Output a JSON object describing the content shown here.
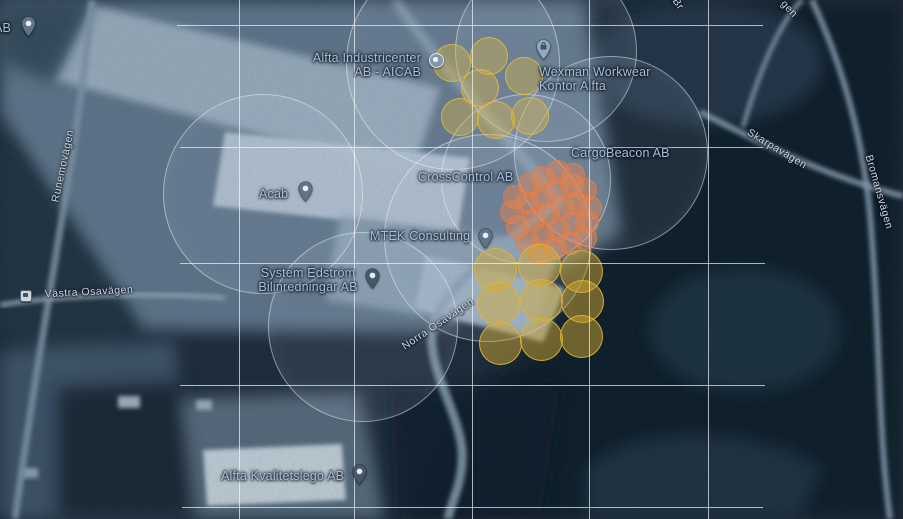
{
  "map": {
    "description_labels": {
      "places": [
        {
          "id": "partial-ab",
          "lines": [
            "AB"
          ],
          "x": -6,
          "y": 22,
          "align": "left"
        },
        {
          "id": "alfta-industricenter",
          "lines": [
            "Alfta Industricenter",
            "AB - AICAB"
          ],
          "x": 421,
          "y": 52,
          "align": "right"
        },
        {
          "id": "wexman-workwear",
          "lines": [
            "Wexman Workwear",
            "Kontor Alfta"
          ],
          "x": 539,
          "y": 66,
          "align": "left"
        },
        {
          "id": "cargobeacon",
          "lines": [
            "CargoBeacon AB"
          ],
          "x": 571,
          "y": 147,
          "align": "left"
        },
        {
          "id": "crosscontrol",
          "lines": [
            "CrossControl AB"
          ],
          "x": 418,
          "y": 171,
          "align": "left"
        },
        {
          "id": "acab",
          "lines": [
            "Acab"
          ],
          "x": 259,
          "y": 188,
          "align": "left"
        },
        {
          "id": "mtek-consulting",
          "lines": [
            "MTEK Consulting"
          ],
          "x": 370,
          "y": 230,
          "align": "left"
        },
        {
          "id": "system-edstrom",
          "lines": [
            "System Edström",
            "Bilinredningar AB"
          ],
          "x": 308,
          "y": 267,
          "align": "center"
        },
        {
          "id": "alfta-kvalitetslego",
          "lines": [
            "Alfta Kvalitetslego AB"
          ],
          "x": 221,
          "y": 470,
          "align": "left"
        }
      ],
      "roads": [
        {
          "id": "runemovagen",
          "text": "Runemovägen",
          "x": 63,
          "y": 166,
          "rotate": -78
        },
        {
          "id": "vastra-osavagen",
          "text": "Västra Osavägen",
          "x": 89,
          "y": 292,
          "rotate": -3
        },
        {
          "id": "norra-osavagen",
          "text": "Norra Osavägen",
          "x": 438,
          "y": 324,
          "rotate": -34
        },
        {
          "id": "skarpavagen",
          "text": "Skarpavägen",
          "x": 777,
          "y": 149,
          "rotate": 31
        },
        {
          "id": "bromansvagen",
          "text": "Bromansvägen",
          "x": 879,
          "y": 192,
          "rotate": 74
        },
        {
          "id": "partial-br",
          "text": "Br",
          "x": 678,
          "y": 4,
          "rotate": 56
        },
        {
          "id": "partial-gen",
          "text": "gen",
          "x": 789,
          "y": 9,
          "rotate": 47
        }
      ]
    },
    "grid": {
      "h_lines": [
        {
          "y": 25,
          "x1": 177,
          "x2": 763
        },
        {
          "y": 147,
          "x1": 180,
          "x2": 763
        },
        {
          "y": 263,
          "x1": 180,
          "x2": 765
        },
        {
          "y": 385,
          "x1": 180,
          "x2": 765
        },
        {
          "y": 507,
          "x1": 182,
          "x2": 763
        }
      ],
      "v_lines": [
        {
          "x": 239,
          "y1": 0,
          "y2": 519
        },
        {
          "x": 354,
          "y1": 0,
          "y2": 519
        },
        {
          "x": 472,
          "y1": 0,
          "y2": 519
        },
        {
          "x": 589,
          "y1": 0,
          "y2": 519
        },
        {
          "x": 708,
          "y1": 0,
          "y2": 519
        }
      ]
    },
    "geofences": [
      {
        "cx": 452,
        "cy": 62,
        "r": 106
      },
      {
        "cx": 545,
        "cy": 50,
        "r": 90
      },
      {
        "cx": 610,
        "cy": 152,
        "r": 96
      },
      {
        "cx": 262,
        "cy": 193,
        "r": 99
      },
      {
        "cx": 525,
        "cy": 178,
        "r": 84
      },
      {
        "cx": 487,
        "cy": 237,
        "r": 103
      },
      {
        "cx": 362,
        "cy": 326,
        "r": 94
      }
    ],
    "clusters": [
      {
        "id": "north-yellow",
        "r": 19,
        "fill": "rgba(216,178,68,0.42)",
        "stroke": "rgba(224,186,58,0.9)",
        "points": [
          [
            452,
            63
          ],
          [
            489,
            56
          ],
          [
            524,
            76
          ],
          [
            480,
            88
          ],
          [
            460,
            117
          ],
          [
            496,
            120
          ],
          [
            530,
            116
          ]
        ]
      },
      {
        "id": "central-orange",
        "r": 12,
        "fill": "rgba(228,134,82,0.45)",
        "stroke": "rgba(234,120,58,0.9)",
        "points": [
          [
            515,
            197
          ],
          [
            530,
            185
          ],
          [
            543,
            178
          ],
          [
            558,
            172
          ],
          [
            573,
            175
          ],
          [
            512,
            212
          ],
          [
            527,
            203
          ],
          [
            542,
            197
          ],
          [
            557,
            190
          ],
          [
            572,
            185
          ],
          [
            585,
            190
          ],
          [
            518,
            227
          ],
          [
            533,
            220
          ],
          [
            548,
            213
          ],
          [
            563,
            207
          ],
          [
            577,
            203
          ],
          [
            590,
            208
          ],
          [
            528,
            242
          ],
          [
            543,
            235
          ],
          [
            558,
            230
          ],
          [
            573,
            223
          ],
          [
            587,
            222
          ],
          [
            540,
            253
          ],
          [
            555,
            248
          ],
          [
            570,
            243
          ],
          [
            585,
            238
          ]
        ]
      },
      {
        "id": "south-yellow",
        "r": 21.5,
        "fill": "rgba(214,172,52,0.48)",
        "stroke": "rgba(222,182,48,0.9)",
        "points": [
          [
            495,
            269
          ],
          [
            539,
            265
          ],
          [
            581,
            271
          ],
          [
            498,
            303
          ],
          [
            541,
            300
          ],
          [
            582,
            301
          ],
          [
            500,
            343
          ],
          [
            541,
            339
          ],
          [
            581,
            336
          ]
        ]
      }
    ],
    "markers": [
      {
        "id": "ab-pin",
        "type": "pin",
        "x": 28,
        "y": 25,
        "variant": "slate"
      },
      {
        "id": "industricenter-dot",
        "type": "dot",
        "x": 435,
        "y": 59
      },
      {
        "id": "wexman-pin",
        "type": "pin-bag",
        "x": 543,
        "y": 48,
        "variant": "light"
      },
      {
        "id": "acab-pin",
        "type": "pin",
        "x": 305,
        "y": 190,
        "variant": "slate"
      },
      {
        "id": "mtek-pin",
        "type": "pin",
        "x": 485,
        "y": 237,
        "variant": "slate"
      },
      {
        "id": "edstrom-pin",
        "type": "pin",
        "x": 372,
        "y": 277,
        "variant": "dark"
      },
      {
        "id": "kvalitetslego-pin",
        "type": "pin",
        "x": 359,
        "y": 473,
        "variant": "dark"
      },
      {
        "id": "bus-stop",
        "type": "bus",
        "x": 25,
        "y": 295
      }
    ],
    "style": {
      "place_label_color": "#a7bfdd",
      "road_label_color": "#ccd7e4",
      "grid_color": "rgba(248,251,254,0.68)",
      "geofence_stroke": "rgba(236,243,249,0.5)",
      "north_cluster_color": "#d8b244",
      "orange_cluster_color": "#e48652",
      "south_cluster_color": "#d6ac34"
    }
  }
}
